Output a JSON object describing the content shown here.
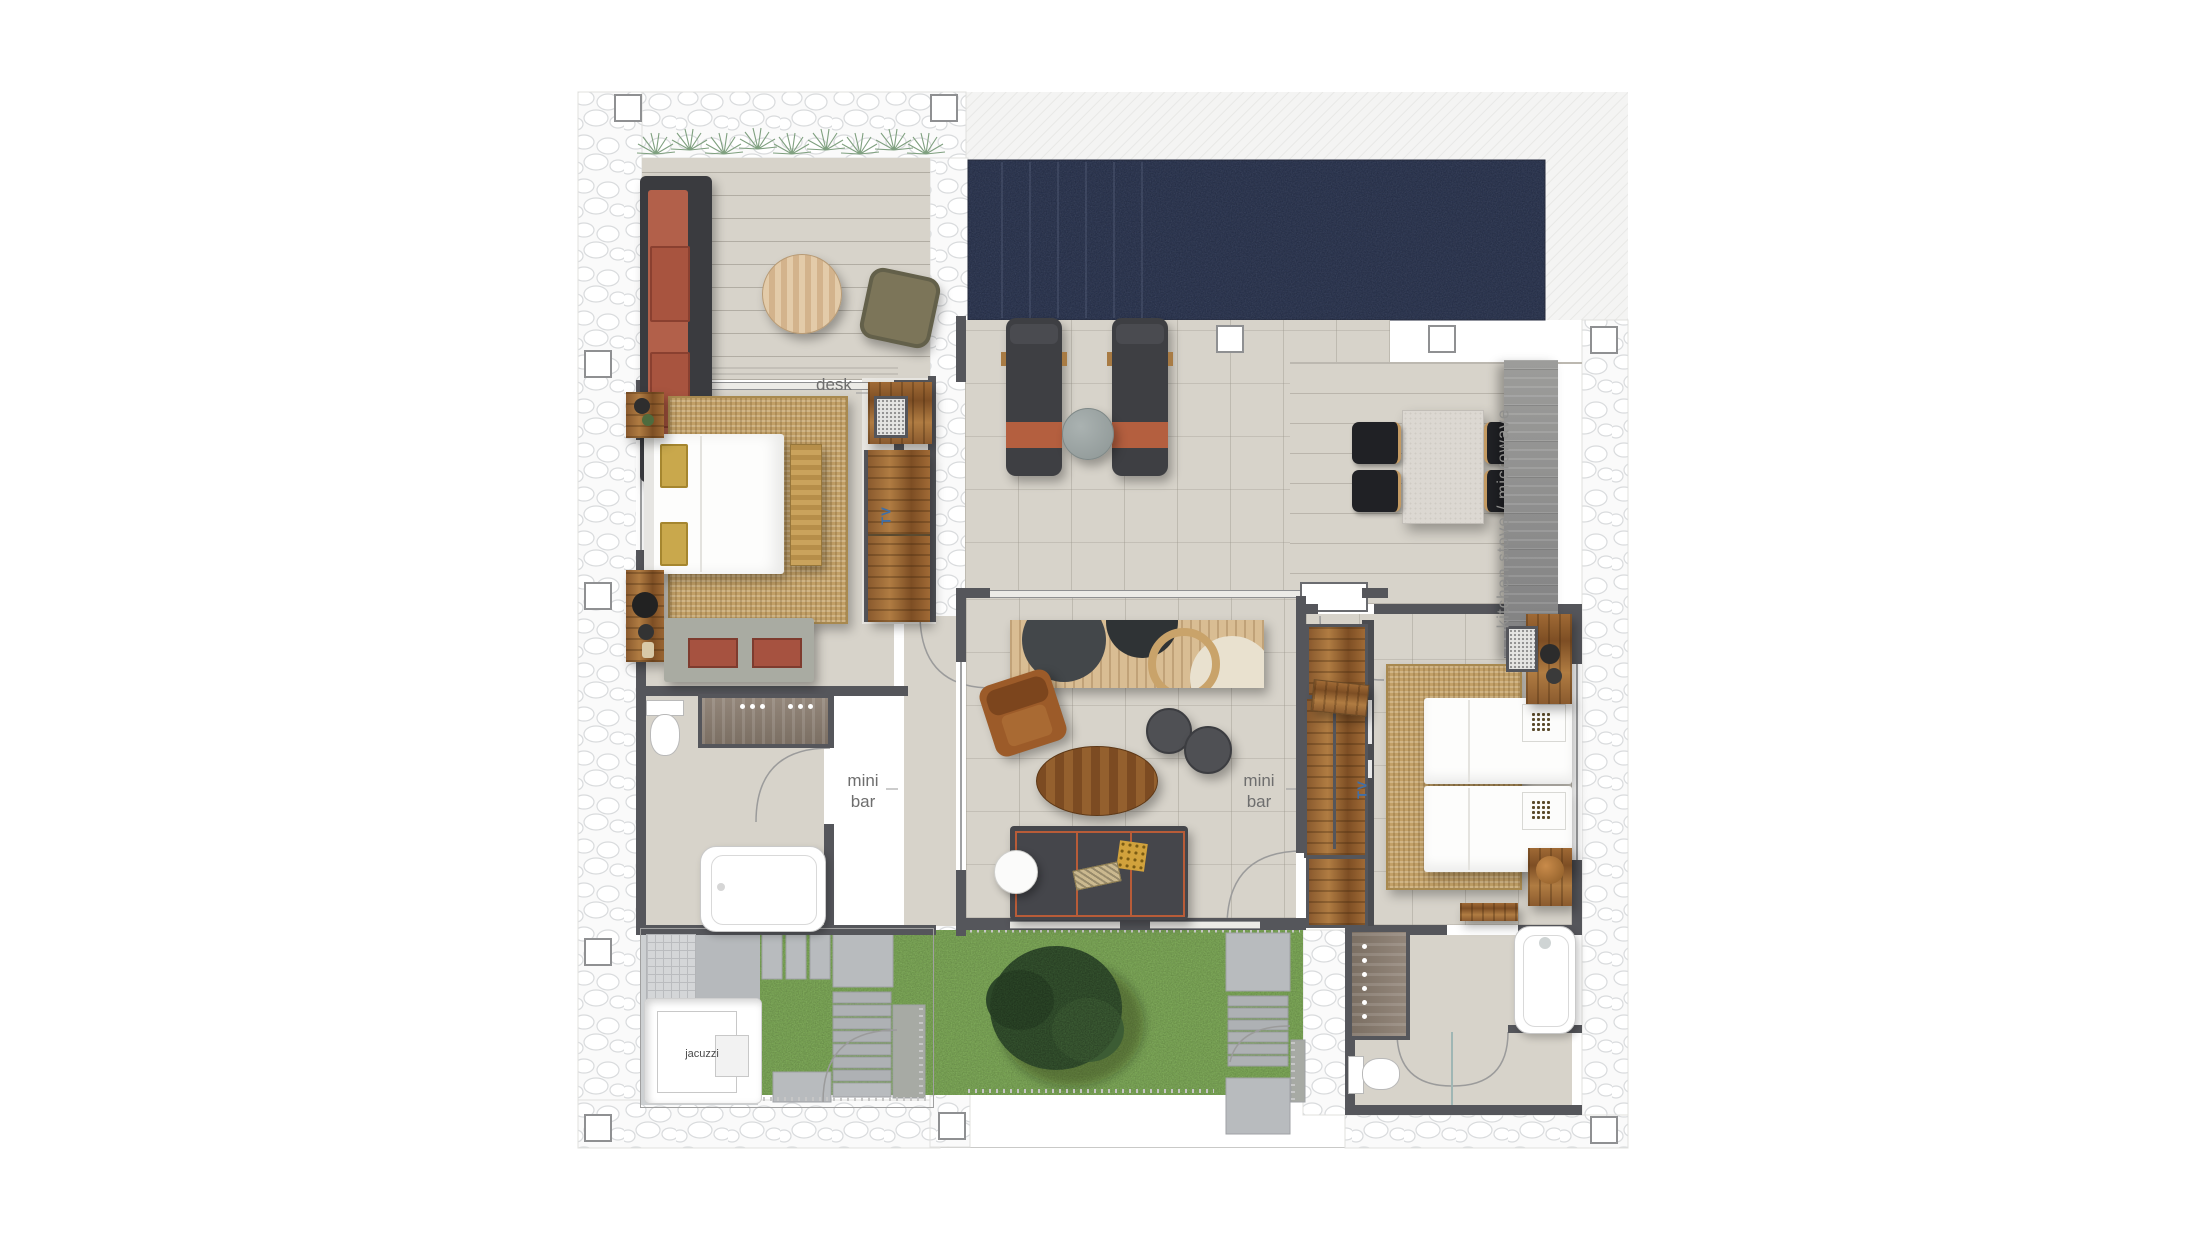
{
  "floor_plan": {
    "labels": {
      "desk": "desk",
      "mini_bar": {
        "line1": "mini",
        "line2": "bar"
      },
      "kitchen_counter": "kitchen stove / microwave",
      "jacuzzi": "jacuzzi",
      "tv": "TV"
    },
    "colors": {
      "background": "#ffffff",
      "pool_water": "#2b3550",
      "floor_tile": "#d7d3ca",
      "wall": "#55565b",
      "wood_furniture": "#8a5a2e",
      "terracotta_cushion": "#b2604a",
      "grass": "#7aa654",
      "jute_rug": "#c2a067",
      "counter_gray": "#8b8b8a",
      "sofa_dark": "#45464b",
      "sofa_trim": "#b85c38",
      "label_text": "#6e6e6e",
      "tv_label_text": "#3f6fa8",
      "stone_outline": "#d9dbdd"
    }
  }
}
